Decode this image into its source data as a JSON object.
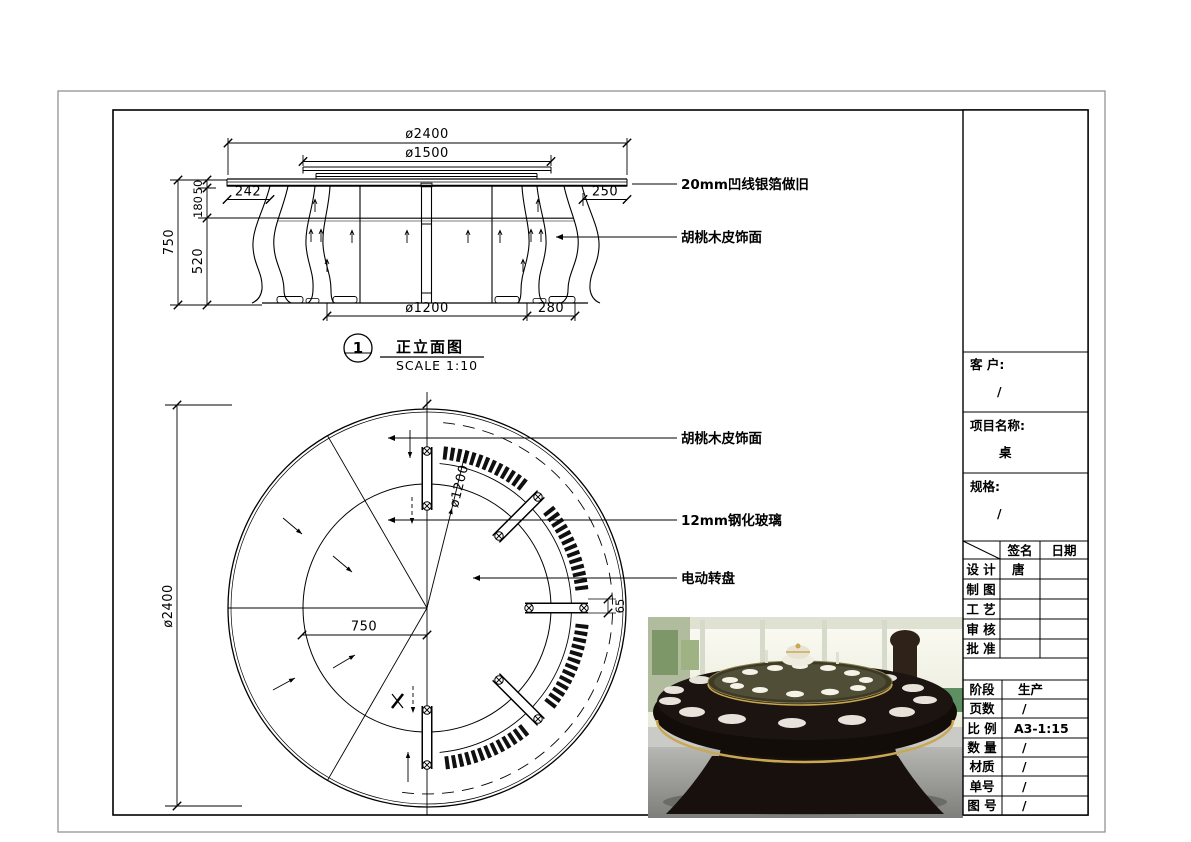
{
  "elevation": {
    "view_number": "1",
    "view_title": "正立面图",
    "view_scale": "SCALE 1:10",
    "dim_top_diameter": "ø2400",
    "dim_turntable_diameter": "ø1500",
    "dim_left_offset": "242",
    "dim_right_offset": "250",
    "dim_height_total": "750",
    "dim_height_top": "50",
    "dim_height_apron": "180",
    "dim_height_leg": "520",
    "dim_base_diameter": "ø1200",
    "dim_base_offset": "280",
    "label_edge": "20mm凹线银箔做旧",
    "label_veneer": "胡桃木皮饰面"
  },
  "plan": {
    "dim_diameter": "ø2400",
    "dim_radius": "750",
    "dim_inner_diameter": "ø1200",
    "dim_ring_width": "65",
    "label_veneer": "胡桃木皮饰面",
    "label_glass": "12mm钢化玻璃",
    "label_turntable": "电动转盘"
  },
  "title_block": {
    "client_label": "客 户:",
    "client_value": "/",
    "project_label": "项目名称:",
    "project_value": "桌",
    "spec_label": "规格:",
    "spec_value": "/",
    "sign_col": "签名",
    "date_col": "日期",
    "rows": [
      {
        "label": "设 计",
        "sign": "唐",
        "date": ""
      },
      {
        "label": "制 图",
        "sign": "",
        "date": ""
      },
      {
        "label": "工 艺",
        "sign": "",
        "date": ""
      },
      {
        "label": "审 核",
        "sign": "",
        "date": ""
      },
      {
        "label": "批 准",
        "sign": "",
        "date": ""
      }
    ],
    "info_rows": [
      {
        "label": "阶段",
        "value": "生产"
      },
      {
        "label": "页数",
        "value": "/"
      },
      {
        "label": "比 例",
        "value": "A3-1:15"
      },
      {
        "label": "数 量",
        "value": "/"
      },
      {
        "label": "材质",
        "value": "/"
      },
      {
        "label": "单号",
        "value": "/"
      },
      {
        "label": "图 号",
        "value": "/"
      }
    ]
  }
}
